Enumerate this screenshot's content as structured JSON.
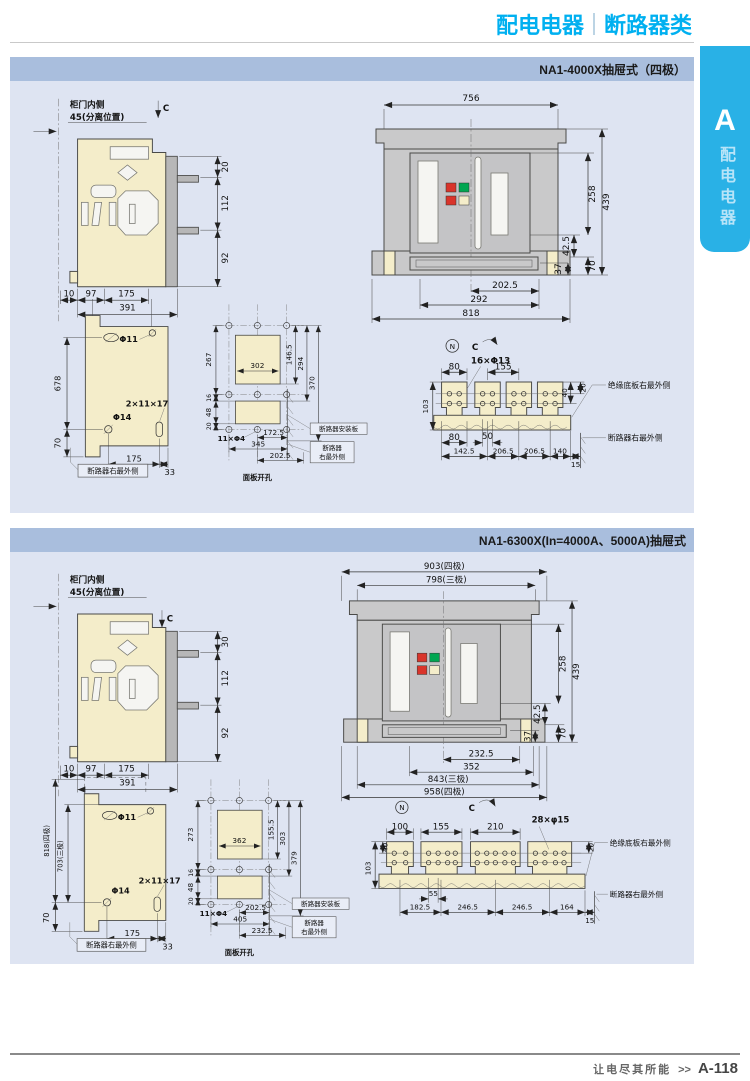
{
  "header": {
    "main": "配电电器",
    "sub": "断路器类"
  },
  "tab": {
    "letter": "A",
    "label": "配电电器"
  },
  "footer": {
    "slogan": "让电尽其所能",
    "arrows": ">>",
    "page": "A-118"
  },
  "colors": {
    "accent": "#00b0f0",
    "tab": "#29b1e6",
    "panel_title_bg": "#a9bedd",
    "panel_bg": "#dee4f2",
    "drawing_beige": "#f4edca",
    "drawing_gray": "#c9c9ca",
    "indicator_red": "#d9342b",
    "indicator_green": "#00a651"
  },
  "p1": {
    "title": "NA1-4000X抽屉式（四极）",
    "side": {
      "note1": "柜门内侧",
      "note2": "45(分离位置)",
      "c": "C",
      "d20": "20",
      "d112": "112",
      "d92": "92",
      "d10": "10",
      "d97": "97",
      "d175": "175",
      "d391": "391"
    },
    "front": {
      "d756": "756",
      "d258": "258",
      "d439": "439",
      "d425": "42.5",
      "d70": "70",
      "d37": "37",
      "d2025": "202.5",
      "d292": "292",
      "d818": "818"
    },
    "plate": {
      "d678": "678",
      "d70": "70",
      "phi11": "Φ11",
      "phi14": "Φ14",
      "slot": "2×11×17",
      "d175": "175",
      "d33": "33",
      "label": "断路器右最外侧"
    },
    "cutout": {
      "d267": "267",
      "d16": "16",
      "d48": "48",
      "d20": "20",
      "d1465": "146.5",
      "d294": "294",
      "d370": "370",
      "d302": "302",
      "holes": "11×Φ4",
      "d1725": "172.5",
      "d345": "345",
      "d2025": "202.5",
      "lbl_plate": "断路器安装板",
      "lbl_e1": "断路器",
      "lbl_e2": "右最外侧",
      "caption": "面板开孔"
    },
    "busbar": {
      "n": "N",
      "c": "C",
      "d80t": "80",
      "holes": "16×Φ13",
      "d155": "155",
      "d40": "40",
      "d20": "20",
      "d103": "103",
      "d80b": "80",
      "d50": "50",
      "d1425": "142.5",
      "d2065a": "206.5",
      "d2065b": "206.5",
      "d140": "140",
      "d15": "15",
      "lbl_base": "绝缘底板右最外侧",
      "lbl_breaker": "断路器右最外侧"
    }
  },
  "p2": {
    "title": "NA1-6300X(In=4000A、5000A)抽屉式",
    "side": {
      "note1": "柜门内侧",
      "note2": "45(分离位置)",
      "c": "C",
      "d30": "30",
      "d112": "112",
      "d92": "92",
      "d10": "10",
      "d97": "97",
      "d175": "175",
      "d391": "391"
    },
    "front": {
      "d903": "903(四极)",
      "d798": "798(三极)",
      "d258": "258",
      "d439": "439",
      "d425": "42.5",
      "d70": "70",
      "d37": "37",
      "d2325": "232.5",
      "d352": "352",
      "d843": "843(三极)",
      "d958": "958(四极)"
    },
    "plate": {
      "d818": "818(四极)",
      "d703": "703(三极)",
      "d70": "70",
      "phi11": "Φ11",
      "phi14": "Φ14",
      "slot": "2×11×17",
      "d175": "175",
      "d33": "33",
      "label": "断路器右最外侧"
    },
    "cutout": {
      "d273": "273",
      "d16": "16",
      "d48": "48",
      "d20": "20",
      "d1555": "155.5",
      "d303": "303",
      "d379": "379",
      "d362": "362",
      "holes": "11×Φ4",
      "d2025": "202.5",
      "d405": "405",
      "d2325": "232.5",
      "lbl_plate": "断路器安装板",
      "lbl_e1": "断路器",
      "lbl_e2": "右最外侧",
      "caption": "面板开孔"
    },
    "busbar": {
      "n": "N",
      "c": "C",
      "d100": "100",
      "d155": "155",
      "d210": "210",
      "holes": "28×φ15",
      "d20": "20",
      "d103": "103",
      "d40": "40",
      "d55": "55",
      "d1825": "182.5",
      "d2465a": "246.5",
      "d2465b": "246.5",
      "d164": "164",
      "d15": "15",
      "lbl_base": "绝缘底板右最外侧",
      "lbl_breaker": "断路器右最外侧"
    }
  }
}
